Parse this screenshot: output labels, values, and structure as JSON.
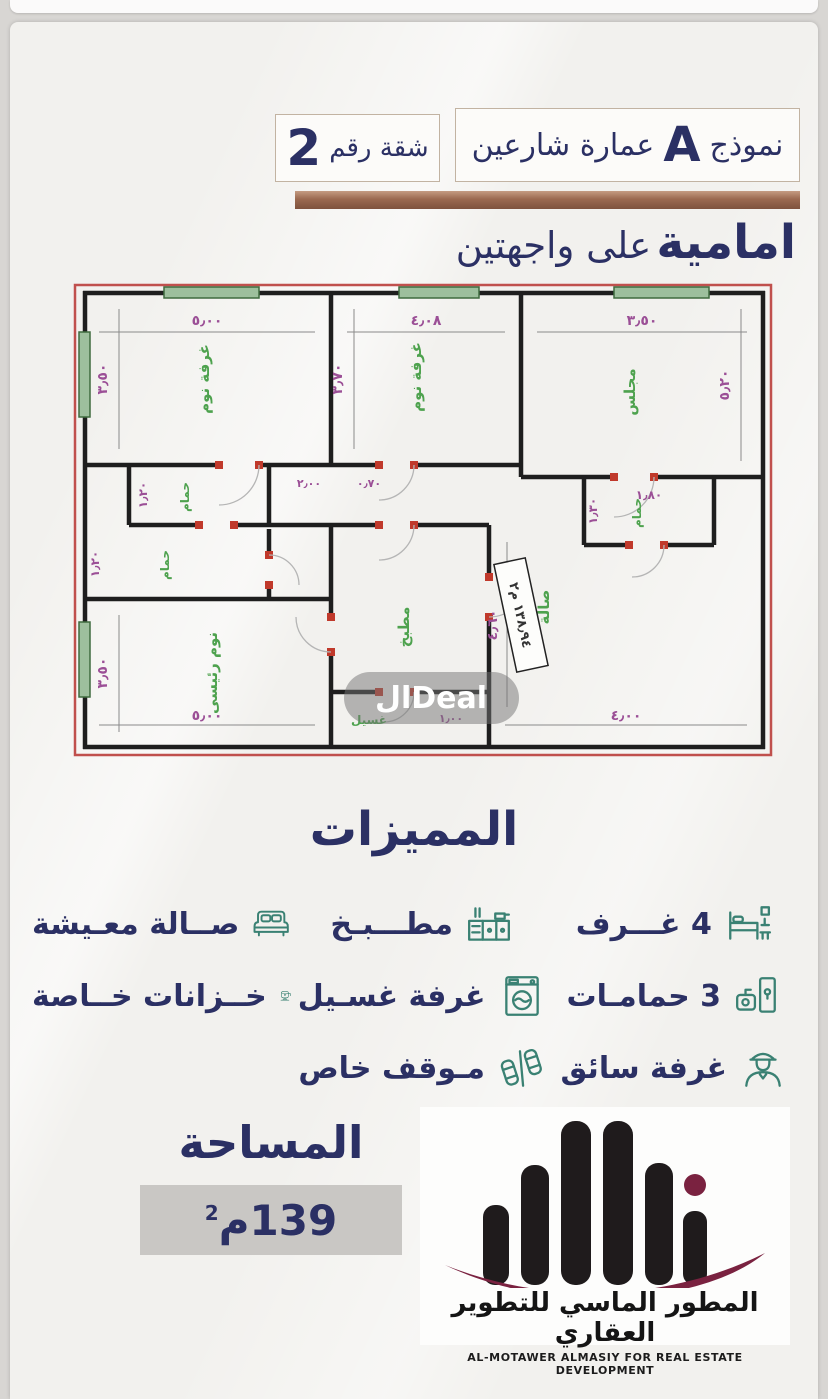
{
  "colors": {
    "navy": "#2b3064",
    "teal": "#3a8173",
    "tan": "#9b6950",
    "maroon": "#7a2240",
    "plan_red": "#c0504d",
    "plan_green": "#4ea24e",
    "plan_purple": "#9b4f96"
  },
  "header": {
    "model_label": "نموذج",
    "model_letter": "A",
    "building_label": "عمارة شارعين",
    "apartment_label": "شقة رقم",
    "apartment_number": "2",
    "subtitle_bold": "امامية",
    "subtitle_rest": "على واجهتين"
  },
  "floorplan": {
    "watermark": "الDeal",
    "area_stamp": "١٣٨٫٩٤ م٢",
    "rooms": [
      "غرفة نوم",
      "غرفة نوم",
      "مجلس",
      "حمام",
      "حمام",
      "حمام",
      "نوم رئيسى",
      "مطبخ",
      "صالة",
      "غسيل"
    ],
    "dims": [
      "٥٫٠٠",
      "٤٫٠٨",
      "٣٫٥٠",
      "٣٫٥٠",
      "٣٫٧٠",
      "٥٫٢٠",
      "١٫٢٠",
      "١٫٢٠",
      "١٫٨٠",
      "١٫٣٠",
      "٣٫٥٠",
      "٥٫٠٠",
      "٤٫٠٠",
      "٤٫٦٠",
      "١٫٠٠",
      "٢٫٠٠",
      "٠٫٧٠"
    ]
  },
  "features": {
    "title": "المميزات",
    "items": [
      {
        "label": "4 غـــرف",
        "icon": "bed-icon"
      },
      {
        "label": "مطـــبـخ",
        "icon": "kitchen-icon"
      },
      {
        "label": "صــالة معـيشة",
        "icon": "sofa-icon"
      },
      {
        "label": "3 حمامـات",
        "icon": "bathroom-icon"
      },
      {
        "label": "غرفة غسـيل",
        "icon": "washer-icon"
      },
      {
        "label": "خــزانات خــاصة",
        "icon": "tank-icon"
      },
      {
        "label": "غرفة سائق",
        "icon": "driver-icon"
      },
      {
        "label": "مـوقف خاص",
        "icon": "parking-icon"
      }
    ]
  },
  "area": {
    "title": "المساحة",
    "value": "139",
    "unit": "م",
    "exponent": "2"
  },
  "logo": {
    "name_ar": "المطور الماسي للتطوير العقاري",
    "name_en": "AL-MOTAWER ALMASIY FOR REAL ESTATE DEVELOPMENT"
  }
}
